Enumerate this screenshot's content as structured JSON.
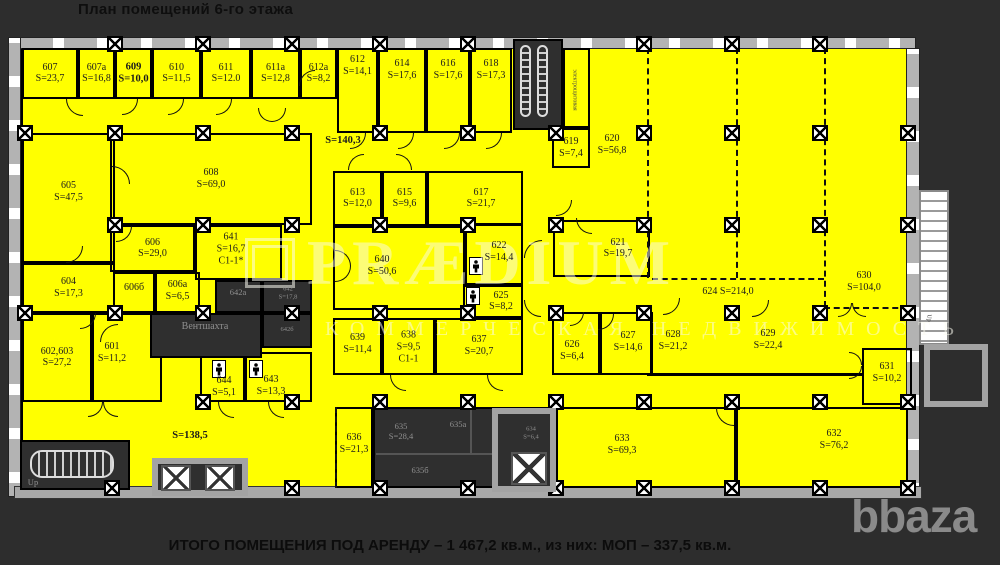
{
  "title": "План помещений 6-го этажа",
  "summary": "ИТОГО ПОМЕЩЕНИЯ ПОД АРЕНДУ – 1 467,2 кв.м., из них: МОП – 337,5 кв.м.",
  "logo": "bbaza",
  "watermark": {
    "brand": "PRÆDIUM",
    "sub": "КОММЕРЧЕСКАЯ НЕДВИЖИМОСТЬ"
  },
  "colors": {
    "floor": "#ffff00",
    "background": "#2d2d2d",
    "service": "#2f2f2f",
    "wall": "#000000",
    "gray_structure": "#a3a3a3",
    "service_text": "#8f8f8f"
  },
  "rooms": [
    {
      "id": "607",
      "x": 22,
      "y": 48,
      "w": 56,
      "h": 51,
      "lines": [
        "607",
        "S=23,7"
      ]
    },
    {
      "id": "607a",
      "x": 78,
      "y": 48,
      "w": 37,
      "h": 51,
      "lines": [
        "607a",
        "S=16,8"
      ]
    },
    {
      "id": "609",
      "x": 115,
      "y": 48,
      "w": 37,
      "h": 51,
      "lines": [
        "609",
        "S=10,0"
      ],
      "bold": true
    },
    {
      "id": "610",
      "x": 152,
      "y": 48,
      "w": 49,
      "h": 51,
      "lines": [
        "610",
        "S=11,5"
      ]
    },
    {
      "id": "611",
      "x": 201,
      "y": 48,
      "w": 50,
      "h": 51,
      "lines": [
        "611",
        "S=12.0"
      ]
    },
    {
      "id": "611a",
      "x": 251,
      "y": 48,
      "w": 49,
      "h": 51,
      "lines": [
        "611a",
        "S=12,8"
      ]
    },
    {
      "id": "612a",
      "x": 300,
      "y": 48,
      "w": 37,
      "h": 51,
      "lines": [
        "612a",
        "S=8,2"
      ]
    },
    {
      "id": "612",
      "x": 337,
      "y": 48,
      "w": 41,
      "h": 85,
      "lines": [
        "612",
        "S=14,1"
      ],
      "ly": 66
    },
    {
      "id": "614",
      "x": 378,
      "y": 48,
      "w": 48,
      "h": 85,
      "lines": [
        "614",
        "S=17,6"
      ],
      "ly": 70
    },
    {
      "id": "616",
      "x": 426,
      "y": 48,
      "w": 44,
      "h": 85,
      "lines": [
        "616",
        "S=17,6"
      ],
      "ly": 70
    },
    {
      "id": "618",
      "x": 470,
      "y": 48,
      "w": 42,
      "h": 85,
      "lines": [
        "618",
        "S=17,3"
      ],
      "ly": 70
    },
    {
      "id": "elec",
      "x": 563,
      "y": 48,
      "w": 27,
      "h": 80,
      "lines": []
    },
    {
      "id": "619",
      "x": 552,
      "y": 128,
      "w": 38,
      "h": 40,
      "lines": [
        "619",
        "S=7,4"
      ]
    },
    {
      "id": "605",
      "x": 22,
      "y": 133,
      "w": 93,
      "h": 130,
      "lines": [
        "605",
        "S=47,5"
      ],
      "ly": 192
    },
    {
      "id": "608",
      "x": 110,
      "y": 133,
      "w": 202,
      "h": 92,
      "lines": [
        "608",
        "S=69,0"
      ]
    },
    {
      "id": "606",
      "x": 110,
      "y": 225,
      "w": 85,
      "h": 47,
      "lines": [
        "606",
        "S=29,0"
      ]
    },
    {
      "id": "641",
      "x": 195,
      "y": 225,
      "w": 87,
      "h": 55,
      "lines": [
        "641",
        "S=16,7",
        "C1-1*"
      ],
      "lx": 231,
      "ly": 249
    },
    {
      "id": "604",
      "x": 22,
      "y": 263,
      "w": 93,
      "h": 50,
      "lines": [
        "604",
        "S=17,3"
      ]
    },
    {
      "id": "602-603",
      "x": 22,
      "y": 313,
      "w": 70,
      "h": 89,
      "lines": [
        "602,603",
        "S=27,2"
      ]
    },
    {
      "id": "601",
      "x": 92,
      "y": 313,
      "w": 70,
      "h": 89,
      "lines": [
        "601",
        "S=11,2"
      ],
      "lx": 112,
      "ly": 353
    },
    {
      "id": "606b",
      "x": 113,
      "y": 272,
      "w": 42,
      "h": 41,
      "lines": [
        "606б"
      ],
      "ly": 288
    },
    {
      "id": "606a",
      "x": 155,
      "y": 272,
      "w": 45,
      "h": 41,
      "lines": [
        "606a",
        "S=6,5"
      ],
      "ly": 291
    },
    {
      "id": "613",
      "x": 333,
      "y": 171,
      "w": 49,
      "h": 55,
      "lines": [
        "613",
        "S=12,0"
      ]
    },
    {
      "id": "615",
      "x": 382,
      "y": 171,
      "w": 45,
      "h": 55,
      "lines": [
        "615",
        "S=9,6"
      ]
    },
    {
      "id": "617",
      "x": 427,
      "y": 171,
      "w": 96,
      "h": 55,
      "lines": [
        "617",
        "S=21,7"
      ],
      "lx": 481
    },
    {
      "id": "640",
      "x": 333,
      "y": 226,
      "w": 132,
      "h": 84,
      "lines": [
        "640",
        "S=50,6"
      ],
      "lx": 382,
      "ly": 266
    },
    {
      "id": "622",
      "x": 465,
      "y": 223,
      "w": 58,
      "h": 62,
      "lines": [
        "622",
        "S=14,4"
      ],
      "lx": 499,
      "ly": 252
    },
    {
      "id": "625",
      "x": 463,
      "y": 285,
      "w": 60,
      "h": 33,
      "lines": [
        "625",
        "S=8,2"
      ],
      "lx": 501
    },
    {
      "id": "621",
      "x": 553,
      "y": 220,
      "w": 97,
      "h": 57,
      "lines": [
        "621",
        "S=19,7"
      ],
      "lx": 618
    },
    {
      "id": "626",
      "x": 552,
      "y": 312,
      "w": 48,
      "h": 63,
      "lines": [
        "626",
        "S=6,4"
      ],
      "lx": 572,
      "ly": 351
    },
    {
      "id": "627",
      "x": 600,
      "y": 312,
      "w": 52,
      "h": 63,
      "lines": [
        "627",
        "S=14,6"
      ],
      "lx": 628,
      "ly": 342
    },
    {
      "id": "628",
      "x": 652,
      "y": 278,
      "w": 84,
      "h": 97,
      "lines": [
        "628",
        "S=21,2"
      ],
      "lx": 673,
      "ly": 341,
      "nobox": true
    },
    {
      "id": "629",
      "x": 736,
      "y": 278,
      "w": 88,
      "h": 97,
      "lines": [
        "629",
        "S=22,4"
      ],
      "lx": 768,
      "ly": 340,
      "nobox": true
    },
    {
      "id": "631",
      "x": 862,
      "y": 348,
      "w": 50,
      "h": 57,
      "lines": [
        "631",
        "S=10,2"
      ],
      "ly": 373
    },
    {
      "id": "639",
      "x": 333,
      "y": 318,
      "w": 49,
      "h": 57,
      "lines": [
        "639",
        "S=11,4"
      ],
      "ly": 344
    },
    {
      "id": "638",
      "x": 382,
      "y": 318,
      "w": 53,
      "h": 57,
      "lines": [
        "638",
        "S=9,5",
        "C1-1"
      ],
      "ly": 347
    },
    {
      "id": "637",
      "x": 435,
      "y": 318,
      "w": 88,
      "h": 57,
      "lines": [
        "637",
        "S=20,7"
      ],
      "ly": 346
    },
    {
      "id": "644",
      "x": 200,
      "y": 352,
      "w": 45,
      "h": 50,
      "lines": [
        "644",
        "S=5,1"
      ],
      "lx": 224,
      "ly": 387
    },
    {
      "id": "643",
      "x": 245,
      "y": 352,
      "w": 67,
      "h": 50,
      "lines": [
        "643",
        "S=13,3"
      ],
      "lx": 271,
      "ly": 386
    },
    {
      "id": "636",
      "x": 335,
      "y": 407,
      "w": 38,
      "h": 81,
      "lines": [
        "636",
        "S=21,3"
      ],
      "ly": 444
    },
    {
      "id": "633",
      "x": 556,
      "y": 407,
      "w": 180,
      "h": 81,
      "lines": [
        "633",
        "S=69,3"
      ],
      "lx": 622,
      "ly": 445
    },
    {
      "id": "632",
      "x": 736,
      "y": 407,
      "w": 172,
      "h": 81,
      "lines": [
        "632",
        "S=76,2"
      ],
      "lx": 834,
      "ly": 440
    }
  ],
  "service_rooms": [
    {
      "id": "stairwell-top",
      "x": 513,
      "y": 39,
      "w": 50,
      "h": 91
    },
    {
      "id": "642a",
      "x": 215,
      "y": 280,
      "w": 47,
      "h": 33
    },
    {
      "id": "642",
      "x": 262,
      "y": 280,
      "w": 50,
      "h": 33
    },
    {
      "id": "642b",
      "x": 262,
      "y": 313,
      "w": 50,
      "h": 35
    },
    {
      "id": "vent-shaft",
      "x": 150,
      "y": 313,
      "w": 112,
      "h": 45
    },
    {
      "id": "serv-635-block",
      "x": 373,
      "y": 407,
      "w": 183,
      "h": 81
    },
    {
      "id": "634",
      "x": 510,
      "y": 412,
      "w": 43,
      "h": 38
    },
    {
      "id": "stairwell-bottom-left",
      "x": 20,
      "y": 440,
      "w": 110,
      "h": 50
    }
  ],
  "labels": [
    {
      "x": 343,
      "y": 141,
      "lines": [
        "S=140,3"
      ],
      "cls": "bold"
    },
    {
      "x": 190,
      "y": 436,
      "lines": [
        "S=138,5"
      ],
      "cls": "bold"
    },
    {
      "x": 612,
      "y": 145,
      "lines": [
        "620",
        "S=56,8"
      ]
    },
    {
      "x": 728,
      "y": 292,
      "lines": [
        "624 S=214,0"
      ]
    },
    {
      "x": 864,
      "y": 282,
      "lines": [
        "630",
        "S=104,0"
      ]
    },
    {
      "x": 205,
      "y": 327,
      "lines": [
        "Вентшахта"
      ],
      "cls": "gray"
    },
    {
      "x": 238,
      "y": 292,
      "lines": [
        "642a"
      ],
      "cls": "gray small"
    },
    {
      "x": 288,
      "y": 293,
      "lines": [
        "642",
        "S=17,8"
      ],
      "cls": "gray tiny"
    },
    {
      "x": 287,
      "y": 330,
      "lines": [
        "642б"
      ],
      "cls": "gray tiny"
    },
    {
      "x": 401,
      "y": 431,
      "lines": [
        "635",
        "S=28,4"
      ],
      "cls": "gray small"
    },
    {
      "x": 458,
      "y": 424,
      "lines": [
        "635a"
      ],
      "cls": "gray small"
    },
    {
      "x": 420,
      "y": 470,
      "lines": [
        "635б"
      ],
      "cls": "gray small"
    },
    {
      "x": 531,
      "y": 433,
      "lines": [
        "634",
        "S=6,4"
      ],
      "cls": "gray tiny"
    },
    {
      "x": 574,
      "y": 90,
      "lines": [
        "электрощитовая"
      ],
      "cls": "vert"
    },
    {
      "x": 33,
      "y": 482,
      "lines": [
        "Up"
      ],
      "cls": "gray small"
    },
    {
      "x": 928,
      "y": 318,
      "lines": [
        "Up"
      ],
      "cls": "vert"
    }
  ],
  "columns": [
    [
      115,
      44
    ],
    [
      203,
      44
    ],
    [
      292,
      44
    ],
    [
      380,
      44
    ],
    [
      468,
      44
    ],
    [
      644,
      44
    ],
    [
      732,
      44
    ],
    [
      820,
      44
    ],
    [
      25,
      133
    ],
    [
      115,
      133
    ],
    [
      203,
      133
    ],
    [
      292,
      133
    ],
    [
      380,
      133
    ],
    [
      468,
      133
    ],
    [
      556,
      133
    ],
    [
      644,
      133
    ],
    [
      732,
      133
    ],
    [
      820,
      133
    ],
    [
      908,
      133
    ],
    [
      115,
      225
    ],
    [
      203,
      225
    ],
    [
      292,
      225
    ],
    [
      380,
      225
    ],
    [
      468,
      225
    ],
    [
      556,
      225
    ],
    [
      644,
      225
    ],
    [
      732,
      225
    ],
    [
      820,
      225
    ],
    [
      908,
      225
    ],
    [
      25,
      313
    ],
    [
      115,
      313
    ],
    [
      203,
      313
    ],
    [
      292,
      313
    ],
    [
      380,
      313
    ],
    [
      468,
      313
    ],
    [
      556,
      313
    ],
    [
      644,
      313
    ],
    [
      732,
      313
    ],
    [
      820,
      313
    ],
    [
      908,
      313
    ],
    [
      203,
      402
    ],
    [
      292,
      402
    ],
    [
      380,
      402
    ],
    [
      468,
      402
    ],
    [
      556,
      402
    ],
    [
      644,
      402
    ],
    [
      732,
      402
    ],
    [
      820,
      402
    ],
    [
      908,
      402
    ],
    [
      112,
      488
    ],
    [
      203,
      488
    ],
    [
      292,
      488
    ],
    [
      380,
      488
    ],
    [
      468,
      488
    ],
    [
      556,
      488
    ],
    [
      644,
      488
    ],
    [
      732,
      488
    ],
    [
      820,
      488
    ],
    [
      908,
      488
    ]
  ],
  "dashed_lines": [
    {
      "x": 647,
      "y": 48,
      "len": 230,
      "dir": "v"
    },
    {
      "x": 736,
      "y": 48,
      "len": 230,
      "dir": "v"
    },
    {
      "x": 824,
      "y": 48,
      "len": 259,
      "dir": "v"
    },
    {
      "x": 652,
      "y": 278,
      "len": 172,
      "dir": "h"
    },
    {
      "x": 824,
      "y": 307,
      "len": 84,
      "dir": "h"
    },
    {
      "x": 335,
      "y": 407,
      "len": 81,
      "dir": "v"
    }
  ],
  "wall_segments": [
    {
      "x": 647,
      "y": 373,
      "w": 179,
      "h": 3
    },
    {
      "x": 824,
      "y": 373,
      "w": 40,
      "h": 3
    },
    {
      "x": 650,
      "y": 312,
      "w": 3,
      "h": 63
    },
    {
      "x": 470,
      "y": 410,
      "w": 2,
      "h": 44,
      "c": "#555"
    },
    {
      "x": 376,
      "y": 453,
      "w": 116,
      "h": 2,
      "c": "#555"
    }
  ],
  "doors": [
    [
      66,
      99,
      17,
      4
    ],
    [
      122,
      99,
      16,
      3
    ],
    [
      168,
      99,
      16,
      3
    ],
    [
      216,
      99,
      16,
      3
    ],
    [
      258,
      108,
      14,
      4
    ],
    [
      272,
      108,
      14,
      3
    ],
    [
      299,
      70,
      16,
      1
    ],
    [
      350,
      133,
      16,
      3
    ],
    [
      398,
      133,
      16,
      3
    ],
    [
      444,
      133,
      16,
      3
    ],
    [
      486,
      133,
      16,
      3
    ],
    [
      112,
      166,
      18,
      2
    ],
    [
      66,
      246,
      17,
      3
    ],
    [
      116,
      226,
      16,
      3
    ],
    [
      80,
      313,
      16,
      3
    ],
    [
      100,
      324,
      18,
      1
    ],
    [
      335,
      250,
      16,
      2
    ],
    [
      335,
      266,
      16,
      3
    ],
    [
      348,
      154,
      16,
      1
    ],
    [
      396,
      154,
      16,
      2
    ],
    [
      524,
      240,
      18,
      1
    ],
    [
      524,
      300,
      17,
      4
    ],
    [
      556,
      200,
      16,
      3
    ],
    [
      576,
      218,
      16,
      4
    ],
    [
      570,
      312,
      14,
      3
    ],
    [
      598,
      314,
      16,
      3
    ],
    [
      663,
      298,
      17,
      3
    ],
    [
      752,
      300,
      17,
      3
    ],
    [
      838,
      303,
      14,
      3
    ],
    [
      852,
      303,
      14,
      4
    ],
    [
      849,
      352,
      13,
      2
    ],
    [
      849,
      366,
      13,
      3
    ],
    [
      716,
      408,
      18,
      4
    ],
    [
      390,
      375,
      16,
      4
    ],
    [
      487,
      375,
      16,
      4
    ],
    [
      218,
      402,
      16,
      4
    ],
    [
      268,
      402,
      16,
      4
    ],
    [
      88,
      402,
      15,
      3
    ],
    [
      103,
      402,
      15,
      4
    ]
  ],
  "wc_icons": [
    [
      212,
      360
    ],
    [
      249,
      360
    ],
    [
      469,
      257
    ],
    [
      466,
      287
    ]
  ]
}
